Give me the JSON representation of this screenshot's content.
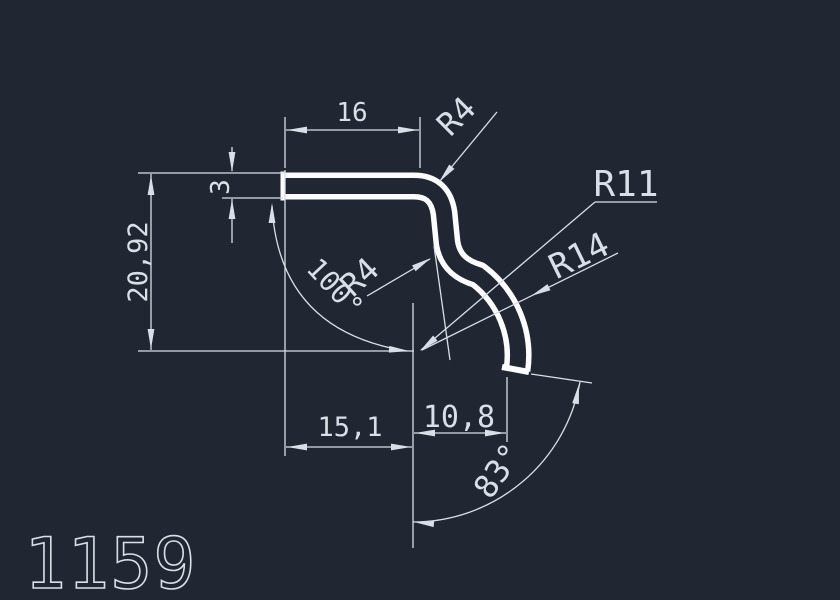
{
  "part_number": "1159",
  "colors": {
    "background": "#202733",
    "profile_line": "#fbfcfe",
    "dimension_line": "#d9dfe7",
    "text": "#d9dfe7"
  },
  "dims": {
    "top_width": "16",
    "wall_thickness": "3",
    "overall_height": "20,92",
    "bottom_offset_left": "15,1",
    "bottom_offset_right": "10,8",
    "bend_angle": "100°",
    "end_face_angle": "83°",
    "corner_radius": "R4",
    "bend_radius": "R4",
    "hook_radius_inner": "R11",
    "hook_radius_outer": "R14"
  }
}
